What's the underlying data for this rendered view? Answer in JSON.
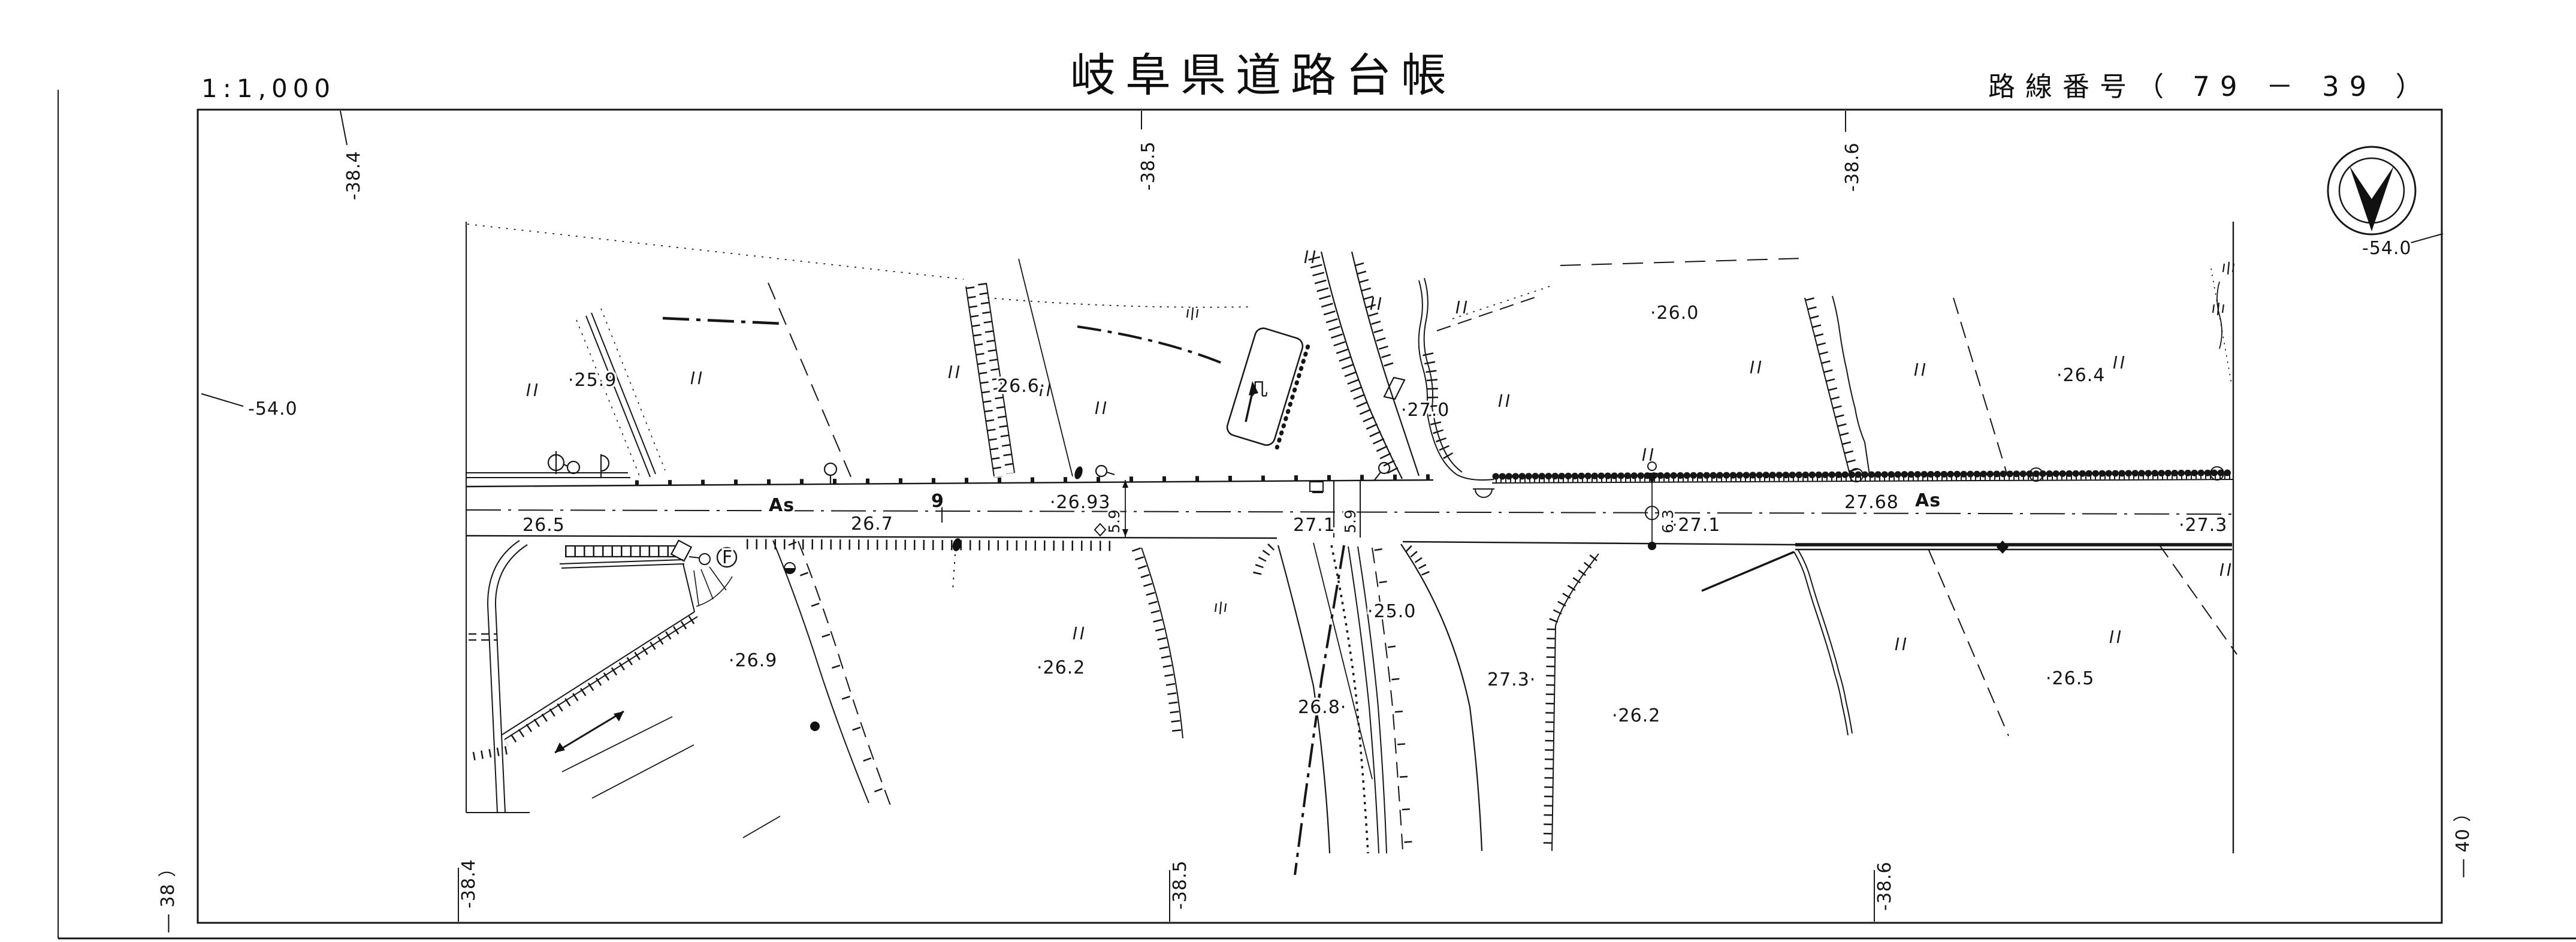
{
  "header": {
    "scale": "1:1,000",
    "title": "岐阜県道路台帳",
    "route_number": "路線番号（ 79 － 39 ）"
  },
  "compass": {
    "grid_label": "-54.0"
  },
  "grid_refs": {
    "top_left": "-38.4",
    "top_center": "-38.5",
    "top_right": "-38.6",
    "left_side": "-54.0",
    "bottom_left": "-38.4",
    "bottom_center": "-38.5",
    "bottom_right": "-38.6",
    "margin_left": "― 38 ）",
    "margin_right": "― 40 ）"
  },
  "road": {
    "surface_left": "As",
    "surface_right": "As",
    "station_number": "9",
    "centerline_elev_left": "·26.93",
    "centerline_elev_right": "27.68",
    "edge_elev_1": "26.5",
    "edge_elev_2": "26.7",
    "edge_elev_3": "27.1",
    "edge_elev_4": "·27.1",
    "edge_elev_5": "·27.3",
    "width_dim_1": "5.9",
    "width_dim_2": "5.9",
    "width_dim_3": "6.3"
  },
  "spot_elevations": {
    "n_259": "·25.9",
    "n_266": "26.6·",
    "n_270": "·27.0",
    "n_260": "·26.0",
    "n_264": "·26.4",
    "n_269": "·26.9",
    "n_262_center": "·26.2",
    "n_250": "·25.0",
    "n_268": "26.8·",
    "n_273_branch": "27.3·",
    "n_262_east": "·26.2",
    "n_265_east": "·26.5"
  },
  "symbols": {
    "hydrant_mark": "F",
    "building_mark": "几"
  }
}
